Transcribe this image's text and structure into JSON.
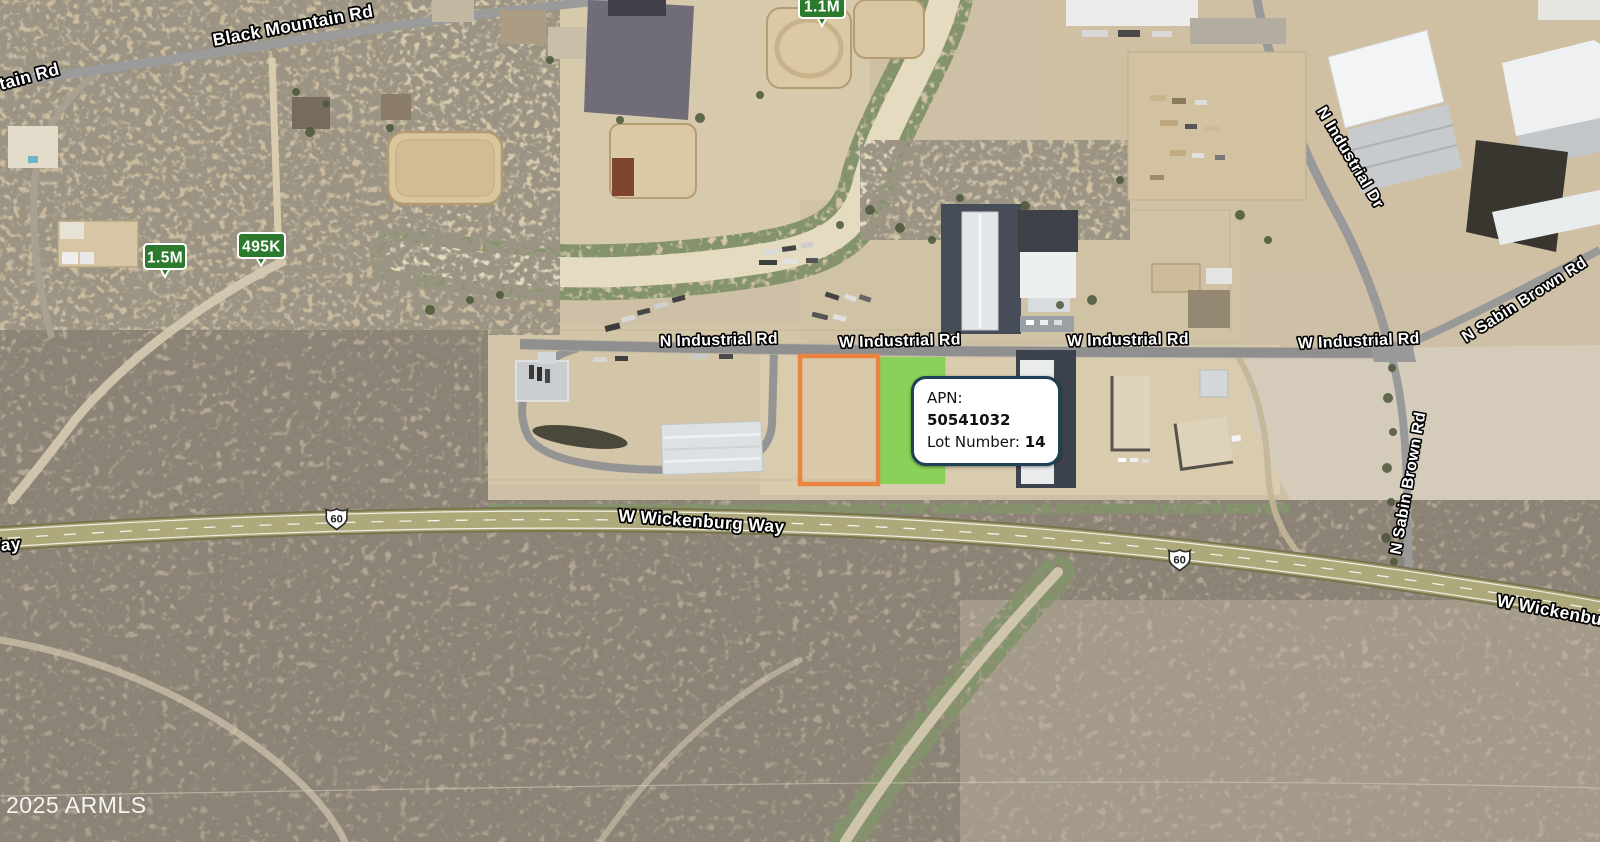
{
  "map": {
    "copyright": "2025 ARMLS",
    "road_labels": [
      {
        "id": "tain-rd",
        "text": "tain Rd"
      },
      {
        "id": "black-mountain-rd",
        "text": "Black Mountain Rd"
      },
      {
        "id": "n-industrial-rd",
        "text": "N Industrial Rd"
      },
      {
        "id": "w-industrial-rd-1",
        "text": "W Industrial Rd"
      },
      {
        "id": "w-industrial-rd-2",
        "text": "W Industrial Rd"
      },
      {
        "id": "w-industrial-rd-3",
        "text": "W Industrial Rd"
      },
      {
        "id": "n-industrial-dr",
        "text": "N Industrial Dr"
      },
      {
        "id": "n-sabin-brown-rd-upper",
        "text": "N Sabin Brown Rd"
      },
      {
        "id": "n-sabin-brown-rd-lower",
        "text": "N Sabin Brown Rd"
      },
      {
        "id": "w-wickenburg-way",
        "text": "W Wickenburg Way"
      },
      {
        "id": "way-partial",
        "text": "Way"
      },
      {
        "id": "w-wickenburg-way-right",
        "text": "W Wickenburg Way"
      }
    ],
    "price_markers": [
      {
        "label": "1.5M"
      },
      {
        "label": "495K"
      },
      {
        "label": "1.1M"
      }
    ],
    "route_shields": [
      {
        "number": "60"
      },
      {
        "number": "60"
      }
    ],
    "parcel_callout": {
      "apn_label": "APN:",
      "apn_value": "50541032",
      "lot_label": "Lot Number:",
      "lot_value": "14"
    },
    "colors": {
      "marker_green": "#2b7a2e",
      "parcel_orange": "#ea8440",
      "parcel_green": "#57d51f",
      "callout_border": "#1d4155",
      "highway": "#a8a274"
    }
  }
}
